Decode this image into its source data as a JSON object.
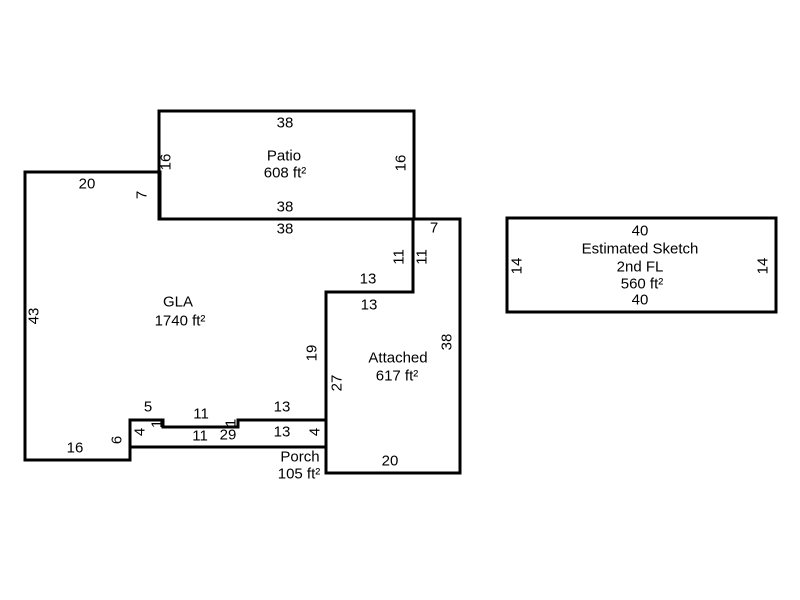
{
  "canvas": {
    "background": "#ffffff",
    "wall_color": "#000000",
    "text_color": "#000000"
  },
  "rooms": [
    {
      "id": "patio",
      "name": "Patio",
      "area": "608 ft²"
    },
    {
      "id": "gla",
      "name": "GLA",
      "area": "1740 ft²"
    },
    {
      "id": "attached",
      "name": "Attached",
      "area": "617 ft²"
    },
    {
      "id": "porch",
      "name": "Porch",
      "area": "105 ft²"
    },
    {
      "id": "second-floor",
      "name": "Estimated Sketch",
      "floor": "2nd FL",
      "area": "560 ft²"
    }
  ],
  "labels": [
    {
      "id": "patio-dim-top",
      "text": "38",
      "x": 285,
      "y": 123,
      "rot": false
    },
    {
      "id": "patio-name",
      "text": "Patio",
      "x": 284,
      "y": 156,
      "rot": false
    },
    {
      "id": "patio-area",
      "text": "608 ft²",
      "x": 285,
      "y": 173,
      "rot": false
    },
    {
      "id": "patio-dim-left",
      "text": "16",
      "x": 166,
      "y": 162,
      "rot": true
    },
    {
      "id": "patio-dim-right",
      "text": "16",
      "x": 401,
      "y": 163,
      "rot": true
    },
    {
      "id": "patio-dim-bottom",
      "text": "38",
      "x": 285,
      "y": 207,
      "rot": false
    },
    {
      "id": "gla-dim-top",
      "text": "38",
      "x": 285,
      "y": 229,
      "rot": false
    },
    {
      "id": "gla-dim-topleft",
      "text": "20",
      "x": 87,
      "y": 184,
      "rot": false
    },
    {
      "id": "gla-dim-step",
      "text": "7",
      "x": 142,
      "y": 195,
      "rot": true
    },
    {
      "id": "gla-dim-leftside",
      "text": "43",
      "x": 34,
      "y": 316,
      "rot": true
    },
    {
      "id": "gla-name",
      "text": "GLA",
      "x": 178,
      "y": 302,
      "rot": false
    },
    {
      "id": "gla-area",
      "text": "1740 ft²",
      "x": 180,
      "y": 321,
      "rot": false
    },
    {
      "id": "gla-dim-right-11",
      "text": "11",
      "x": 399,
      "y": 257,
      "rot": true
    },
    {
      "id": "attached-dim-left-11",
      "text": "11",
      "x": 422,
      "y": 257,
      "rot": true
    },
    {
      "id": "attached-dim-top-7",
      "text": "7",
      "x": 434,
      "y": 228,
      "rot": false
    },
    {
      "id": "gla-dim-13",
      "text": "13",
      "x": 368,
      "y": 279,
      "rot": false
    },
    {
      "id": "attached-dim-13",
      "text": "13",
      "x": 369,
      "y": 305,
      "rot": false
    },
    {
      "id": "gla-dim-19",
      "text": "19",
      "x": 312,
      "y": 353,
      "rot": true
    },
    {
      "id": "attached-dim-27",
      "text": "27",
      "x": 337,
      "y": 383,
      "rot": true
    },
    {
      "id": "attached-name",
      "text": "Attached",
      "x": 398,
      "y": 358,
      "rot": false
    },
    {
      "id": "attached-area",
      "text": "617 ft²",
      "x": 397,
      "y": 376,
      "rot": false
    },
    {
      "id": "attached-dim-right",
      "text": "38",
      "x": 447,
      "y": 342,
      "rot": true
    },
    {
      "id": "attached-dim-bottom",
      "text": "20",
      "x": 390,
      "y": 461,
      "rot": false
    },
    {
      "id": "gla-dim-5",
      "text": "5",
      "x": 148,
      "y": 407,
      "rot": false
    },
    {
      "id": "gla-dim-1-left",
      "text": "1",
      "x": 157,
      "y": 424,
      "rot": true
    },
    {
      "id": "gla-dim-11-bottom",
      "text": "11",
      "x": 201,
      "y": 414,
      "rot": false
    },
    {
      "id": "gla-dim-1-right",
      "text": "1",
      "x": 231,
      "y": 423,
      "rot": true
    },
    {
      "id": "gla-dim-13-bottom",
      "text": "13",
      "x": 282,
      "y": 407,
      "rot": false
    },
    {
      "id": "porch-dim-11",
      "text": "11",
      "x": 200,
      "y": 436,
      "rot": false
    },
    {
      "id": "porch-dim-29",
      "text": "29",
      "x": 228,
      "y": 435,
      "rot": false
    },
    {
      "id": "porch-dim-13",
      "text": "13",
      "x": 282,
      "y": 432,
      "rot": false
    },
    {
      "id": "porch-dim-4-left",
      "text": "4",
      "x": 140,
      "y": 432,
      "rot": true
    },
    {
      "id": "porch-dim-4-right",
      "text": "4",
      "x": 315,
      "y": 432,
      "rot": true
    },
    {
      "id": "gla-dim-6",
      "text": "6",
      "x": 117,
      "y": 440,
      "rot": true
    },
    {
      "id": "gla-dim-16",
      "text": "16",
      "x": 75,
      "y": 448,
      "rot": false
    },
    {
      "id": "porch-name",
      "text": "Porch",
      "x": 300,
      "y": 457,
      "rot": false
    },
    {
      "id": "porch-area",
      "text": "105 ft²",
      "x": 299,
      "y": 474,
      "rot": false
    },
    {
      "id": "second-floor-dim-top",
      "text": "40",
      "x": 640,
      "y": 231,
      "rot": false
    },
    {
      "id": "second-floor-title",
      "text": "Estimated Sketch",
      "x": 640,
      "y": 249,
      "rot": false
    },
    {
      "id": "second-floor-subtitle",
      "text": "2nd FL",
      "x": 640,
      "y": 267,
      "rot": false
    },
    {
      "id": "second-floor-area",
      "text": "560 ft²",
      "x": 642,
      "y": 284,
      "rot": false
    },
    {
      "id": "second-floor-dim-bottom",
      "text": "40",
      "x": 640,
      "y": 300,
      "rot": false
    },
    {
      "id": "second-floor-dim-left",
      "text": "14",
      "x": 517,
      "y": 266,
      "rot": true
    },
    {
      "id": "second-floor-dim-right",
      "text": "14",
      "x": 763,
      "y": 266,
      "rot": true
    }
  ]
}
